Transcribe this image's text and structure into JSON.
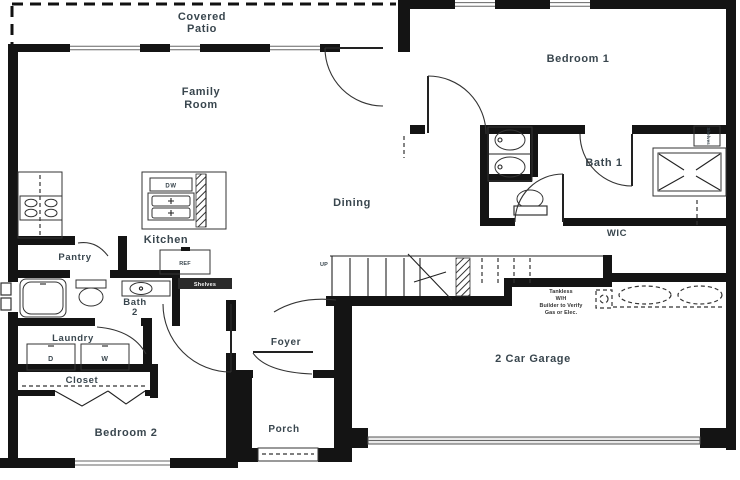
{
  "colors": {
    "paper": "#ffffff",
    "wall": "#141414",
    "label": "#39464e",
    "shelf_bar": "#2a2a2a",
    "shelf_bar_text": "#f5f5f5"
  },
  "rooms": {
    "covered_patio": {
      "line1": "Covered",
      "line2": "Patio"
    },
    "family_room": {
      "line1": "Family",
      "line2": "Room"
    },
    "bedroom1": {
      "label": "Bedroom 1"
    },
    "bath1": {
      "label": "Bath 1"
    },
    "wic": {
      "label": "WIC"
    },
    "dining": {
      "label": "Dining"
    },
    "kitchen": {
      "label": "Kitchen"
    },
    "pantry": {
      "label": "Pantry"
    },
    "bath2": {
      "line1": "Bath",
      "line2": "2"
    },
    "laundry": {
      "label": "Laundry"
    },
    "closet": {
      "label": "Closet"
    },
    "bedroom2": {
      "label": "Bedroom 2"
    },
    "foyer": {
      "label": "Foyer"
    },
    "porch": {
      "label": "Porch"
    },
    "garage": {
      "label": "2 Car Garage"
    }
  },
  "appliances": {
    "dishwasher": "DW",
    "refrigerator": "REF",
    "dryer": "D",
    "washer": "W"
  },
  "labels": {
    "stairs_up": "UP",
    "hall_shelves": "Shelves",
    "wic_shelves": "Shelves"
  },
  "notes": {
    "water_heater": [
      "Tankless",
      "W/H",
      "Builder to Verify",
      "Gas or Elec."
    ]
  }
}
